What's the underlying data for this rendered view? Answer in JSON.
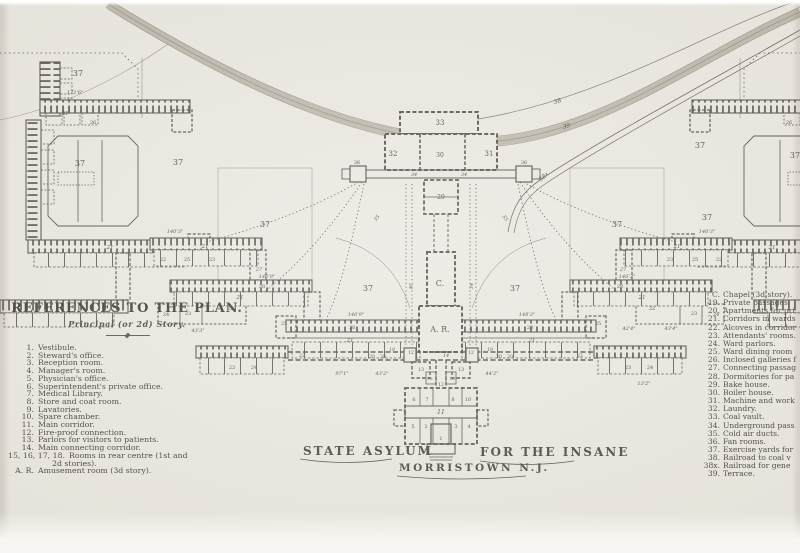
{
  "page": {
    "paper_color": "#e9e6de",
    "line_color": "#46433c",
    "band_color": "#b3ac9f"
  },
  "legend_left": {
    "title": "REFERENCES TO THE PLAN.",
    "subtitle": "Principal (or 2d) Story.",
    "items": [
      {
        "n": "1.",
        "t": "Vestibule."
      },
      {
        "n": "2.",
        "t": "Steward's office."
      },
      {
        "n": "3.",
        "t": "Reception room."
      },
      {
        "n": "4.",
        "t": "Manager's room."
      },
      {
        "n": "5.",
        "t": "Physician's office."
      },
      {
        "n": "6.",
        "t": "Superintendent's private office."
      },
      {
        "n": "7.",
        "t": "Medical Library."
      },
      {
        "n": "8.",
        "t": "Store and coat room."
      },
      {
        "n": "9.",
        "t": "Lavatories."
      },
      {
        "n": "10.",
        "t": "Spare chamber."
      },
      {
        "n": "11.",
        "t": "Main corridor."
      },
      {
        "n": "12.",
        "t": "Fire-proof connection."
      },
      {
        "n": "13.",
        "t": "Parlors for visitors to patients."
      },
      {
        "n": "14.",
        "t": "Main connecting corridor."
      },
      {
        "n": "15, 16, 17, 18.",
        "t": "Rooms in rear centre (1st and",
        "t2": "2d stories)."
      },
      {
        "n": "A. R.",
        "t": "Amusement room (3d story)."
      }
    ]
  },
  "legend_right": {
    "items": [
      {
        "n": "C.",
        "t": "Chapel (3d story)."
      },
      {
        "n": "19.",
        "t": "Private passages."
      },
      {
        "n": "20.",
        "t": "Apartments for pri"
      },
      {
        "n": "21.",
        "t": "Corridors in wards"
      },
      {
        "n": "22.",
        "t": "Alcoves in corridor"
      },
      {
        "n": "23.",
        "t": "Attendants' rooms."
      },
      {
        "n": "24.",
        "t": "Ward parlors."
      },
      {
        "n": "25.",
        "t": "Ward dining room"
      },
      {
        "n": "26.",
        "t": "Inclosed galleries f"
      },
      {
        "n": "27.",
        "t": "Connecting passag"
      },
      {
        "n": "28.",
        "t": "Dormitories for pa"
      },
      {
        "n": "29.",
        "t": "Bake house."
      },
      {
        "n": "30.",
        "t": "Boiler house."
      },
      {
        "n": "31.",
        "t": "Machine and work"
      },
      {
        "n": "32.",
        "t": "Laundry."
      },
      {
        "n": "33.",
        "t": "Coal vault."
      },
      {
        "n": "34.",
        "t": "Underground pass"
      },
      {
        "n": "35.",
        "t": "Cold air ducts."
      },
      {
        "n": "36.",
        "t": "Fan rooms."
      },
      {
        "n": "37.",
        "t": "Exercise yards for"
      },
      {
        "n": "38.",
        "t": "Railroad to coal v"
      },
      {
        "n": "38x.",
        "t": "Railroad for gene"
      },
      {
        "n": "39.",
        "t": "Terrace."
      }
    ]
  },
  "title": {
    "left": "STATE ASYLUM",
    "right": "FOR THE INSANE",
    "bottom": "MORRISTOWN N.J."
  },
  "plan": {
    "labels": [
      {
        "t": "37",
        "x": 78,
        "y": 76,
        "s": 8
      },
      {
        "t": "37",
        "x": 80,
        "y": 166,
        "s": 8
      },
      {
        "t": "37",
        "x": 178,
        "y": 165,
        "s": 8
      },
      {
        "t": "37",
        "x": 265,
        "y": 227,
        "s": 8
      },
      {
        "t": "37",
        "x": 368,
        "y": 291,
        "s": 8
      },
      {
        "t": "37",
        "x": 515,
        "y": 291,
        "s": 8
      },
      {
        "t": "37",
        "x": 617,
        "y": 227,
        "s": 8
      },
      {
        "t": "37",
        "x": 700,
        "y": 148,
        "s": 8
      },
      {
        "t": "37",
        "x": 707,
        "y": 220,
        "s": 8
      },
      {
        "t": "37",
        "x": 795,
        "y": 158,
        "s": 8
      },
      {
        "t": "33",
        "x": 440,
        "y": 125,
        "s": 7
      },
      {
        "t": "32",
        "x": 393,
        "y": 156,
        "s": 7
      },
      {
        "t": "30",
        "x": 440,
        "y": 157,
        "s": 6
      },
      {
        "t": "31",
        "x": 489,
        "y": 156,
        "s": 7
      },
      {
        "t": "34",
        "x": 414,
        "y": 176,
        "s": 5,
        "i": 1
      },
      {
        "t": "34",
        "x": 464,
        "y": 176,
        "s": 5,
        "i": 1
      },
      {
        "t": "36",
        "x": 357,
        "y": 164,
        "s": 5
      },
      {
        "t": "36",
        "x": 524,
        "y": 164,
        "s": 5
      },
      {
        "t": "29",
        "x": 441,
        "y": 199,
        "s": 6
      },
      {
        "t": "C.",
        "x": 440,
        "y": 286,
        "s": 8
      },
      {
        "t": "A. R.",
        "x": 440,
        "y": 332,
        "s": 8
      },
      {
        "t": "14",
        "x": 446,
        "y": 357,
        "s": 5,
        "i": 1
      },
      {
        "t": "12",
        "x": 411,
        "y": 354,
        "s": 4.5
      },
      {
        "t": "12",
        "x": 471,
        "y": 354,
        "s": 4.5
      },
      {
        "t": "13",
        "x": 421,
        "y": 371,
        "s": 5
      },
      {
        "t": "13",
        "x": 461,
        "y": 371,
        "s": 5
      },
      {
        "t": "12",
        "x": 441,
        "y": 386,
        "s": 4.5
      },
      {
        "t": "15",
        "x": 430,
        "y": 380,
        "s": 4
      },
      {
        "t": "16",
        "x": 452,
        "y": 380,
        "s": 4
      },
      {
        "t": "11",
        "x": 441,
        "y": 414,
        "s": 6,
        "i": 1
      },
      {
        "t": "1",
        "x": 441,
        "y": 440,
        "s": 5
      },
      {
        "t": "2",
        "x": 426,
        "y": 428,
        "s": 5
      },
      {
        "t": "3",
        "x": 456,
        "y": 428,
        "s": 5
      },
      {
        "t": "4",
        "x": 469,
        "y": 428,
        "s": 5
      },
      {
        "t": "5",
        "x": 413,
        "y": 428,
        "s": 5
      },
      {
        "t": "6",
        "x": 414,
        "y": 401,
        "s": 5
      },
      {
        "t": "7",
        "x": 427,
        "y": 401,
        "s": 5
      },
      {
        "t": "8",
        "x": 453,
        "y": 401,
        "s": 5
      },
      {
        "t": "10",
        "x": 468,
        "y": 401,
        "s": 5
      },
      {
        "t": "19",
        "x": 392,
        "y": 351,
        "s": 4.5,
        "i": 1
      },
      {
        "t": "19",
        "x": 490,
        "y": 351,
        "s": 4.5,
        "i": 1
      },
      {
        "t": "20",
        "x": 372,
        "y": 358,
        "s": 4.5
      },
      {
        "t": "20",
        "x": 383,
        "y": 358,
        "s": 4.5
      },
      {
        "t": "20",
        "x": 499,
        "y": 358,
        "s": 4.5
      },
      {
        "t": "20",
        "x": 510,
        "y": 358,
        "s": 4.5
      },
      {
        "t": "22",
        "x": 302,
        "y": 357,
        "s": 4.5
      },
      {
        "t": "22",
        "x": 580,
        "y": 357,
        "s": 4.5
      },
      {
        "t": "35",
        "x": 378,
        "y": 219,
        "s": 5,
        "r": -55,
        "i": 1
      },
      {
        "t": "35",
        "x": 504,
        "y": 219,
        "s": 5,
        "r": 55,
        "i": 1
      },
      {
        "t": "34",
        "x": 409,
        "y": 286,
        "s": 5,
        "r": 90,
        "i": 1
      },
      {
        "t": "34",
        "x": 473,
        "y": 286,
        "s": 5,
        "r": -90,
        "i": 1
      },
      {
        "t": "21",
        "x": 65,
        "y": 115,
        "s": 5.5,
        "i": 1
      },
      {
        "t": "21",
        "x": 110,
        "y": 249,
        "s": 5.5,
        "i": 1
      },
      {
        "t": "21",
        "x": 205,
        "y": 248,
        "s": 5.5,
        "i": 1
      },
      {
        "t": "21",
        "x": 240,
        "y": 299,
        "s": 5.5,
        "i": 1
      },
      {
        "t": "21",
        "x": 350,
        "y": 342,
        "s": 5.5,
        "i": 1
      },
      {
        "t": "21",
        "x": 532,
        "y": 342,
        "s": 5.5,
        "i": 1
      },
      {
        "t": "21",
        "x": 642,
        "y": 299,
        "s": 5.5,
        "i": 1
      },
      {
        "t": "21",
        "x": 677,
        "y": 248,
        "s": 5.5,
        "i": 1
      },
      {
        "t": "21",
        "x": 772,
        "y": 249,
        "s": 5.5,
        "i": 1
      },
      {
        "t": "26",
        "x": 93,
        "y": 124,
        "s": 5
      },
      {
        "t": "26",
        "x": 789,
        "y": 124,
        "s": 5
      },
      {
        "t": "28",
        "x": 352,
        "y": 329,
        "s": 5
      },
      {
        "t": "28",
        "x": 530,
        "y": 329,
        "s": 5
      },
      {
        "t": "28",
        "x": 262,
        "y": 288,
        "s": 5
      },
      {
        "t": "28",
        "x": 620,
        "y": 288,
        "s": 5
      },
      {
        "t": "27",
        "x": 259,
        "y": 271,
        "s": 5,
        "i": 1
      },
      {
        "t": "27",
        "x": 623,
        "y": 271,
        "s": 5,
        "i": 1
      },
      {
        "t": "22",
        "x": 163,
        "y": 261,
        "s": 5
      },
      {
        "t": "25",
        "x": 187,
        "y": 261,
        "s": 5
      },
      {
        "t": "23",
        "x": 212,
        "y": 261,
        "s": 5
      },
      {
        "t": "24",
        "x": 166,
        "y": 316,
        "s": 5
      },
      {
        "t": "23",
        "x": 188,
        "y": 315,
        "s": 5
      },
      {
        "t": "22",
        "x": 230,
        "y": 310,
        "s": 5
      },
      {
        "t": "25",
        "x": 284,
        "y": 325,
        "s": 5
      },
      {
        "t": "23",
        "x": 232,
        "y": 369,
        "s": 5
      },
      {
        "t": "24",
        "x": 254,
        "y": 369,
        "s": 5
      },
      {
        "t": "22",
        "x": 719,
        "y": 261,
        "s": 5
      },
      {
        "t": "25",
        "x": 695,
        "y": 261,
        "s": 5
      },
      {
        "t": "23",
        "x": 670,
        "y": 261,
        "s": 5
      },
      {
        "t": "24",
        "x": 716,
        "y": 316,
        "s": 5
      },
      {
        "t": "23",
        "x": 694,
        "y": 315,
        "s": 5
      },
      {
        "t": "22",
        "x": 652,
        "y": 310,
        "s": 5
      },
      {
        "t": "25",
        "x": 598,
        "y": 325,
        "s": 5
      },
      {
        "t": "23",
        "x": 628,
        "y": 369,
        "s": 5
      },
      {
        "t": "24",
        "x": 650,
        "y": 369,
        "s": 5
      },
      {
        "t": "38",
        "x": 558,
        "y": 103,
        "s": 6,
        "r": -18,
        "i": 1
      },
      {
        "t": "39",
        "x": 567,
        "y": 128,
        "s": 6,
        "r": -18,
        "i": 1
      },
      {
        "t": "38x",
        "x": 545,
        "y": 178,
        "s": 6,
        "r": -42,
        "i": 1
      },
      {
        "t": "172'6\"",
        "x": 75,
        "y": 94,
        "s": 5,
        "i": 1
      },
      {
        "t": "140'3\"",
        "x": 175,
        "y": 233,
        "s": 5,
        "i": 1
      },
      {
        "t": "146'9\"",
        "x": 267,
        "y": 278,
        "s": 5,
        "i": 1
      },
      {
        "t": "146'9\"",
        "x": 356,
        "y": 316,
        "s": 5,
        "i": 1
      },
      {
        "t": "148'3\"",
        "x": 527,
        "y": 316,
        "s": 5,
        "i": 1
      },
      {
        "t": "146'3\"",
        "x": 627,
        "y": 278,
        "s": 5,
        "i": 1
      },
      {
        "t": "140'3\"",
        "x": 707,
        "y": 233,
        "s": 5,
        "i": 1
      },
      {
        "t": "43'3\"",
        "x": 198,
        "y": 332,
        "s": 5,
        "i": 1
      },
      {
        "t": "97'1\"",
        "x": 342,
        "y": 375,
        "s": 5,
        "i": 1
      },
      {
        "t": "43'2\"",
        "x": 382,
        "y": 375,
        "s": 5,
        "i": 1
      },
      {
        "t": "44'2\"",
        "x": 492,
        "y": 375,
        "s": 5,
        "i": 1
      },
      {
        "t": "42'4\"",
        "x": 629,
        "y": 330,
        "s": 5,
        "i": 1
      },
      {
        "t": "43'4\"",
        "x": 671,
        "y": 330,
        "s": 5,
        "i": 1
      },
      {
        "t": "13'2\"",
        "x": 644,
        "y": 385,
        "s": 5,
        "i": 1
      }
    ]
  }
}
